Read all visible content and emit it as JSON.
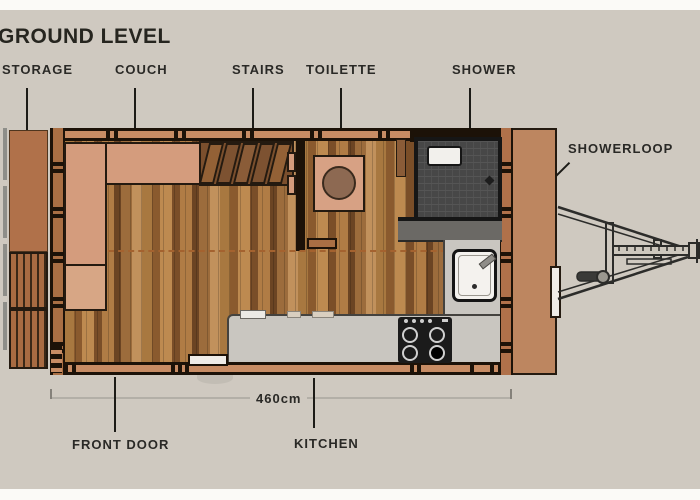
{
  "title": "GROUND LEVEL",
  "callouts": {
    "storage": "STORAGE",
    "couch": "COUCH",
    "stairs": "STAIRS",
    "toilette": "TOILETTE",
    "shower": "SHOWER",
    "showerloop": "SHOWERLOOP",
    "front_door": "FRONT DOOR",
    "kitchen": "KITCHEN"
  },
  "dimension": {
    "length": "460cm"
  },
  "colors": {
    "background": "#cfc9c0",
    "paper_band": "#fbfaf7",
    "text": "#2a2926",
    "wall_fill": "#c78c64",
    "wall_outline": "#1c1208",
    "storage_wood": "#b0714a",
    "deck_wood": "#bd8660",
    "couch": "#d49c7d",
    "toilet_platform": "#d7a184",
    "toilet_seat": "#8d6952",
    "shower_tile": "#474747",
    "showerloop_counter": "#6b6965",
    "kitchen_counter": "#c9c6c0",
    "stove": "#1b1b1b",
    "sink": "#f4f2ee",
    "loft_dash": "#a4622f",
    "dimension_line": "#b3afa7"
  }
}
